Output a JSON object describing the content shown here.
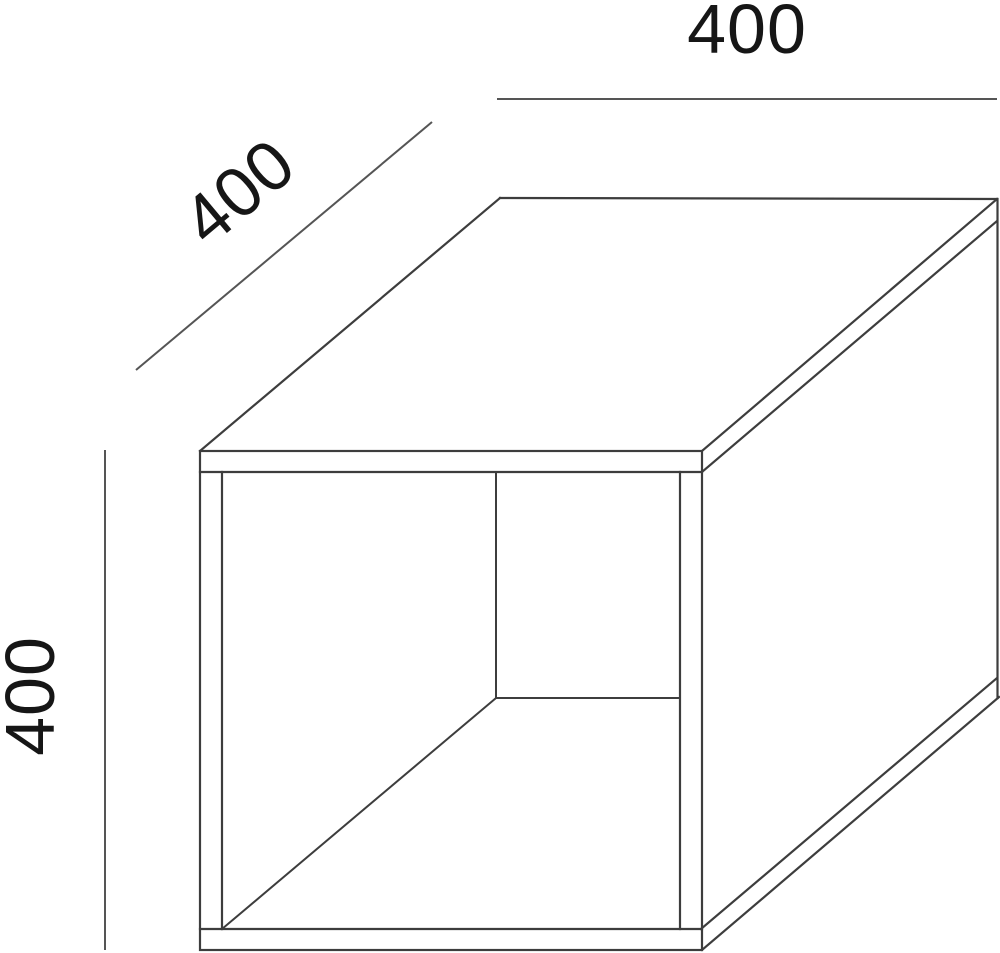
{
  "drawing": {
    "title": "open cube furniture dimension drawing",
    "object": "open-front storage cube shown in oblique projection",
    "dimensions": {
      "width_label": "400",
      "depth_label": "400",
      "height_label": "400"
    },
    "colors": {
      "background": "#ffffff",
      "cube_line": "#3d3d3d",
      "dimension_line": "#555555",
      "text": "#161616"
    }
  }
}
